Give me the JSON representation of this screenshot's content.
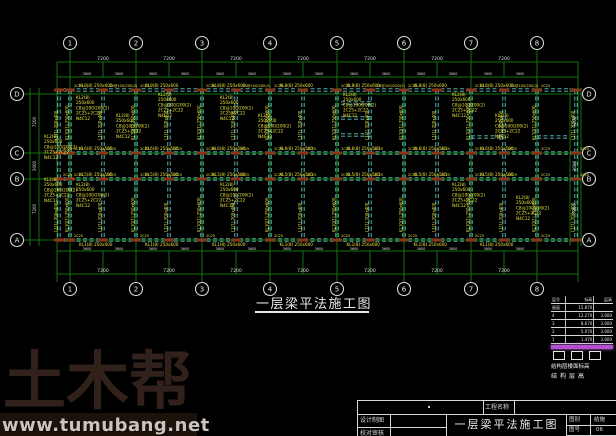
{
  "drawing_title": "一层梁平法施工图",
  "grid": {
    "cols": [
      "1",
      "2",
      "3",
      "4",
      "5",
      "6",
      "7",
      "8"
    ],
    "rows": [
      "D",
      "C",
      "B",
      "A"
    ]
  },
  "dimensions": {
    "bay": "7200",
    "half": "3600",
    "side_upper": "7200",
    "side_corridor": "3000",
    "side_lower": "7200"
  },
  "beam_labels": {
    "d_axis": "KL8(8) 250x600",
    "c_axis": "KL6(8) 250x500",
    "b_axis": "KL5(8) 250x500",
    "a_axis": "KL1(8) 250x600",
    "stirrup": "C8@100/200(2)",
    "v_axis": "KL10(1) 250x600",
    "v_mid": "L1(1) 200x400",
    "support": "2C25",
    "cluster_lines": [
      "KL2(8)",
      "250x600",
      "C8@100/200(2)",
      "2C25+2C22",
      "N4C12"
    ],
    "cluster_positions": [
      {
        "x": 76,
        "y": 99
      },
      {
        "x": 116,
        "y": 117
      },
      {
        "x": 158,
        "y": 96
      },
      {
        "x": 220,
        "y": 99
      },
      {
        "x": 258,
        "y": 117
      },
      {
        "x": 343,
        "y": 96
      },
      {
        "x": 452,
        "y": 96
      },
      {
        "x": 495,
        "y": 117
      },
      {
        "x": 44,
        "y": 138
      },
      {
        "x": 44,
        "y": 181
      },
      {
        "x": 76,
        "y": 186
      },
      {
        "x": 220,
        "y": 186
      },
      {
        "x": 452,
        "y": 186
      },
      {
        "x": 516,
        "y": 199
      }
    ]
  },
  "elevation_table": {
    "header": [
      "层号",
      "标高",
      "层高"
    ],
    "rows": [
      [
        "屋面",
        "15.870",
        ""
      ],
      [
        "4",
        "12.270",
        "3.600"
      ],
      [
        "3",
        "8.670",
        "3.600"
      ],
      [
        "2",
        "5.070",
        "3.600"
      ],
      [
        "1",
        "1.470",
        "3.600"
      ]
    ],
    "caption1": "结构层楼面标高",
    "caption2": "结构层高"
  },
  "title_block": {
    "project_label": "工程名称",
    "design_label": "设计制图",
    "check_label": "校对审核",
    "drawing_name": "一层梁平法施工图",
    "field1_label": "图别",
    "field1_value": "结施",
    "field2_label": "图号",
    "field2_value": "06",
    "field3_label": "日期",
    "field3_value": ""
  },
  "watermark": {
    "brand": "土木帮",
    "url": "www.tumubang.net"
  },
  "colors": {
    "grid_green": "#117311",
    "beam_cyan": "#63c6c6",
    "anno_yellow": "#e8e23c",
    "support_red": "#8c3416",
    "dim_white": "#dedede",
    "magenta": "#b44fd0",
    "watermark_brown": "#31211a",
    "watermark_gray": "#c9c5be"
  }
}
